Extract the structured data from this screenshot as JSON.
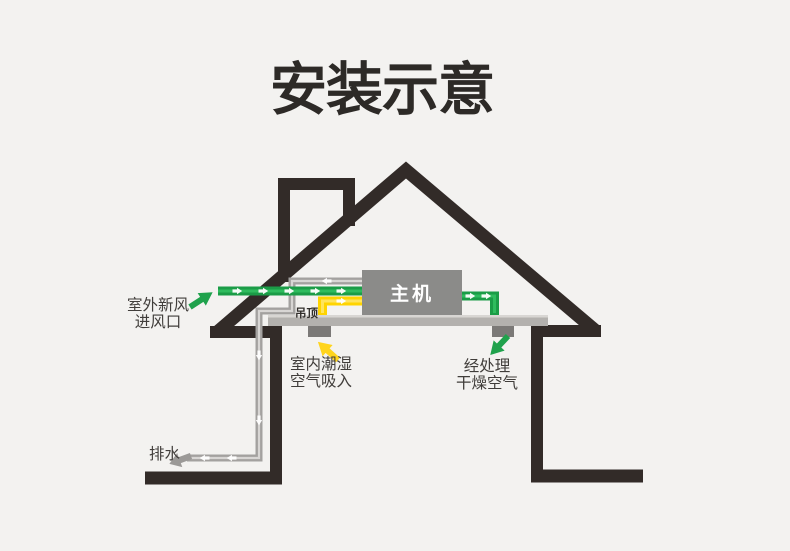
{
  "title": "安装示意",
  "diagram": {
    "main_unit_label": "主机",
    "ceiling_label": "吊顶",
    "labels": {
      "fresh_air_line1": "室外新风",
      "fresh_air_line2": "进风口",
      "indoor_air_line1": "室内潮湿",
      "indoor_air_line2": "空气吸入",
      "dry_air_line1": "经处理",
      "dry_air_line2": "干燥空气",
      "drain": "排水"
    },
    "icons": {
      "fresh_air_arrow": "thick-arrow-up-right-green",
      "humid_air_arrow": "thick-arrow-up-left-yellow",
      "dry_air_arrow": "thick-arrow-down-left-green",
      "drain_arrow": "thick-arrow-down-left-gray",
      "flow_marks": "small-white-flow-arrows"
    },
    "colors": {
      "background": "#f3f2f0",
      "outline_black": "#322b28",
      "duct_green": "#1b9c47",
      "duct_green_highlight": "#2fbc5e",
      "duct_yellow": "#ffd400",
      "pipe_gray": "#a3a19f",
      "pipe_gray_highlight": "#d8d6d4",
      "ceiling_gray": "#b3b1ae",
      "vent_gray": "#7b7977",
      "unit_gray": "#8b8b89",
      "title_text": "#2d2a27",
      "label_text": "#403d3a"
    }
  }
}
